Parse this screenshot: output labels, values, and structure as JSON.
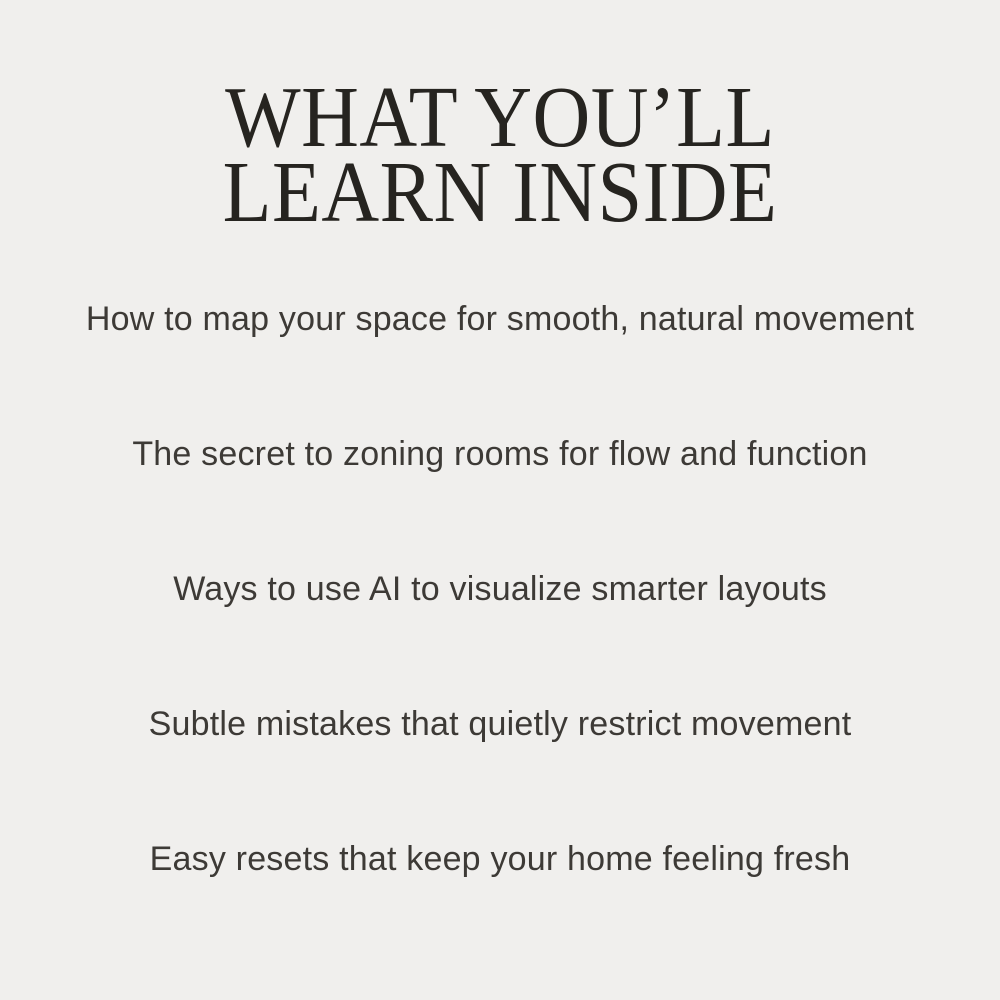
{
  "page": {
    "background_color": "#f0efed",
    "heading_color": "#262420",
    "body_color": "#3d3a36"
  },
  "heading": {
    "line1": "WHAT YOU’LL",
    "line2": "LEARN INSIDE"
  },
  "learn_points": [
    "How to map your space for smooth, natural movement",
    "The secret to zoning rooms for flow and function",
    "Ways to use AI to visualize smarter layouts",
    "Subtle mistakes that quietly restrict movement",
    "Easy resets that keep your home feeling fresh"
  ]
}
